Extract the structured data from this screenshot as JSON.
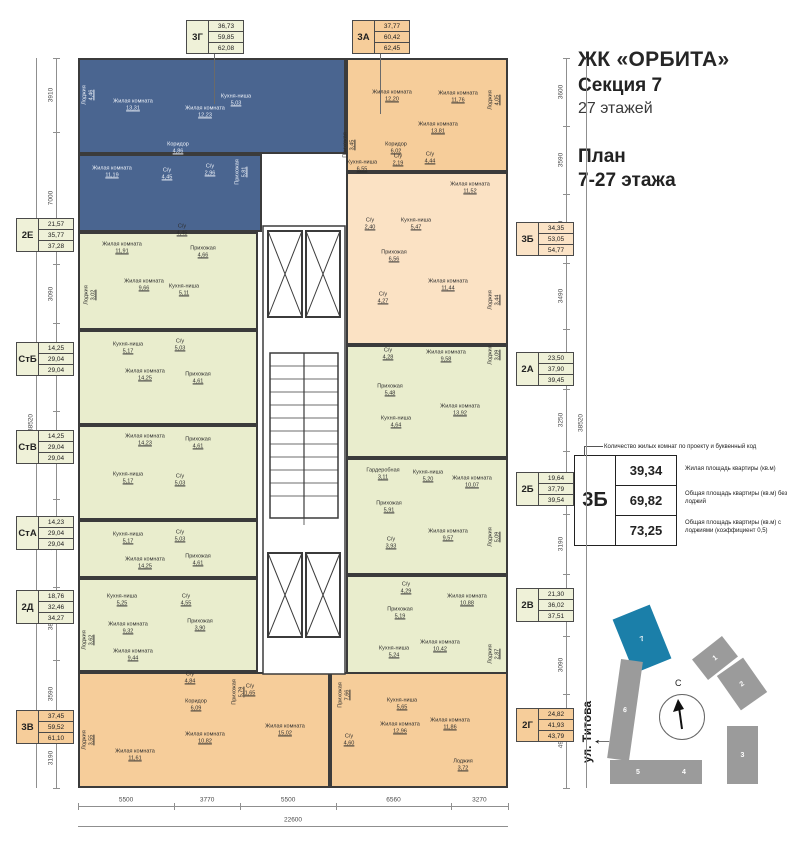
{
  "header": {
    "title": "ЖК «ОРБИТА»",
    "section": "Секция 7",
    "floors": "27 этажей",
    "plan_label": "План",
    "plan_floors": "7-27 этажа"
  },
  "legend": {
    "note": "Количество жилых комнат по проекту и буквенный код",
    "code": "3Б",
    "rows": [
      {
        "value": "39,34",
        "desc": "Жилая площадь квартиры (кв.м)"
      },
      {
        "value": "69,82",
        "desc": "Общая площадь квартиры (кв.м) без лоджий"
      },
      {
        "value": "73,25",
        "desc": "Общая площадь квартиры (кв.м) с лоджиями (коэффициент 0,5)"
      }
    ]
  },
  "site_plan": {
    "street": "ул. Титова",
    "north": "С",
    "street_arrow": "←",
    "highlighted": "7",
    "buildings": [
      "1",
      "2",
      "3",
      "4",
      "5",
      "6",
      "7"
    ]
  },
  "dimensions": {
    "left": [
      "3910",
      "7000",
      "3090",
      "4650",
      "4650",
      "4650",
      "3850",
      "3590",
      "3190"
    ],
    "right": [
      "3600",
      "3590",
      "3650",
      "3490",
      "3190",
      "3250",
      "3350",
      "3190",
      "3250",
      "3090",
      "4970"
    ],
    "bottom": [
      "5500",
      "3770",
      "5500",
      "6560",
      "3270"
    ],
    "total_width": "22600",
    "total_height": "38520"
  },
  "apartments": [
    {
      "code": "3Г",
      "area_living": "36,73",
      "area_total": "59,85",
      "area_total_loggia": "62,08",
      "rooms": [
        {
          "name": "Лоджия",
          "area": "4,46"
        },
        {
          "name": "Жилая комната",
          "area": "13,31"
        },
        {
          "name": "Жилая комната",
          "area": "12,23"
        },
        {
          "name": "Кухня-ниша",
          "area": "5,03"
        },
        {
          "name": "Жилая комната",
          "area": "11,19"
        },
        {
          "name": "Коридор",
          "area": "4,86"
        },
        {
          "name": "С/у",
          "area": "4,45"
        },
        {
          "name": "С/у",
          "area": "2,96"
        },
        {
          "name": "Прихожая",
          "area": "5,81"
        }
      ]
    },
    {
      "code": "3А",
      "area_living": "37,77",
      "area_total": "60,42",
      "area_total_loggia": "62,45",
      "rooms": [
        {
          "name": "Жилая комната",
          "area": "12,20"
        },
        {
          "name": "Жилая комната",
          "area": "11,76"
        },
        {
          "name": "Жилая комната",
          "area": "13,81"
        },
        {
          "name": "Кухня-ниша",
          "area": "6,55"
        },
        {
          "name": "Коридор",
          "area": "6,02"
        },
        {
          "name": "С/у",
          "area": "2,19"
        },
        {
          "name": "С/у",
          "area": "4,44"
        },
        {
          "name": "Прихожая",
          "area": "3,45"
        },
        {
          "name": "Лоджия",
          "area": "4,05"
        }
      ]
    },
    {
      "code": "3Б",
      "area_living": "34,35",
      "area_total": "53,05",
      "area_total_loggia": "54,77",
      "rooms": [
        {
          "name": "Жилая комната",
          "area": "11,52"
        },
        {
          "name": "С/у",
          "area": "2,40"
        },
        {
          "name": "Кухня-ниша",
          "area": "5,47"
        },
        {
          "name": "Прихожая",
          "area": "6,56"
        },
        {
          "name": "Жилая комната",
          "area": "11,44"
        },
        {
          "name": "С/у",
          "area": "4,27"
        },
        {
          "name": "Лоджия",
          "area": "3,44"
        }
      ]
    },
    {
      "code": "2Е",
      "area_living": "21,57",
      "area_total": "35,77",
      "area_total_loggia": "37,28",
      "rooms": [
        {
          "name": "Жилая комната",
          "area": "11,91"
        },
        {
          "name": "С/у",
          "area": "4,45"
        },
        {
          "name": "Прихожая",
          "area": "4,66"
        },
        {
          "name": "Жилая комната",
          "area": "9,66"
        },
        {
          "name": "Кухня-ниша",
          "area": "5,11"
        },
        {
          "name": "Лоджия",
          "area": "3,02"
        }
      ]
    },
    {
      "code": "СтБ",
      "area_living": "14,25",
      "area_total": "29,04",
      "area_total_loggia": "29,04",
      "rooms": [
        {
          "name": "Кухня-ниша",
          "area": "5,17"
        },
        {
          "name": "С/у",
          "area": "5,03"
        },
        {
          "name": "Жилая комната",
          "area": "14,25"
        },
        {
          "name": "Прихожая",
          "area": "4,61"
        }
      ]
    },
    {
      "code": "СтВ",
      "area_living": "14,25",
      "area_total": "29,04",
      "area_total_loggia": "29,04",
      "rooms": [
        {
          "name": "Жилая комната",
          "area": "14,23"
        },
        {
          "name": "Прихожая",
          "area": "4,61"
        },
        {
          "name": "Кухня-ниша",
          "area": "5,17"
        },
        {
          "name": "С/у",
          "area": "5,03"
        }
      ]
    },
    {
      "code": "СтА",
      "area_living": "14,23",
      "area_total": "29,04",
      "area_total_loggia": "29,04",
      "rooms": [
        {
          "name": "Кухня-ниша",
          "area": "5,17"
        },
        {
          "name": "С/у",
          "area": "5,03"
        },
        {
          "name": "Жилая комната",
          "area": "14,25"
        },
        {
          "name": "Прихожая",
          "area": "4,61"
        }
      ]
    },
    {
      "code": "2Д",
      "area_living": "18,76",
      "area_total": "32,46",
      "area_total_loggia": "34,27",
      "rooms": [
        {
          "name": "Кухня-ниша",
          "area": "5,25"
        },
        {
          "name": "С/у",
          "area": "4,55"
        },
        {
          "name": "Жилая комната",
          "area": "9,32"
        },
        {
          "name": "Прихожая",
          "area": "3,90"
        },
        {
          "name": "Жилая комната",
          "area": "9,44"
        },
        {
          "name": "Лоджия",
          "area": "3,62"
        }
      ]
    },
    {
      "code": "3В",
      "area_living": "37,45",
      "area_total": "59,52",
      "area_total_loggia": "61,10",
      "rooms": [
        {
          "name": "Прихожая",
          "area": "5,79"
        },
        {
          "name": "С/у",
          "area": "4,84"
        },
        {
          "name": "С/у",
          "area": "1,65"
        },
        {
          "name": "Коридор",
          "area": "6,09"
        },
        {
          "name": "Жилая комната",
          "area": "11,61"
        },
        {
          "name": "Жилая комната",
          "area": "10,82"
        },
        {
          "name": "Жилая комната",
          "area": "15,02"
        },
        {
          "name": "Лоджия",
          "area": "3,55"
        }
      ]
    },
    {
      "code": "2А",
      "area_living": "23,50",
      "area_total": "37,90",
      "area_total_loggia": "39,45",
      "rooms": [
        {
          "name": "С/у",
          "area": "4,28"
        },
        {
          "name": "Жилая комната",
          "area": "9,58"
        },
        {
          "name": "Прихожая",
          "area": "5,48"
        },
        {
          "name": "Жилая комната",
          "area": "13,92"
        },
        {
          "name": "Кухня-ниша",
          "area": "4,64"
        },
        {
          "name": "Лоджия",
          "area": "3,09"
        }
      ]
    },
    {
      "code": "2Б",
      "area_living": "19,64",
      "area_total": "37,79",
      "area_total_loggia": "39,54",
      "rooms": [
        {
          "name": "Гардеробная",
          "area": "3,11"
        },
        {
          "name": "Кухня-ниша",
          "area": "5,20"
        },
        {
          "name": "Жилая комната",
          "area": "10,07"
        },
        {
          "name": "Прихожая",
          "area": "5,91"
        },
        {
          "name": "С/у",
          "area": "3,93"
        },
        {
          "name": "Жилая комната",
          "area": "9,57"
        },
        {
          "name": "Лоджия",
          "area": "5,09"
        }
      ]
    },
    {
      "code": "2В",
      "area_living": "21,30",
      "area_total": "36,02",
      "area_total_loggia": "37,51",
      "rooms": [
        {
          "name": "С/у",
          "area": "4,29"
        },
        {
          "name": "Прихожая",
          "area": "5,19"
        },
        {
          "name": "Жилая комната",
          "area": "10,88"
        },
        {
          "name": "Жилая комната",
          "area": "10,42"
        },
        {
          "name": "Кухня-ниша",
          "area": "5,24"
        },
        {
          "name": "Лоджия",
          "area": "2,87"
        }
      ]
    },
    {
      "code": "2Г",
      "area_living": "24,82",
      "area_total": "41,93",
      "area_total_loggia": "43,79",
      "rooms": [
        {
          "name": "Прихожая",
          "area": "7,66"
        },
        {
          "name": "Кухня-ниша",
          "area": "5,65"
        },
        {
          "name": "Жилая комната",
          "area": "12,96"
        },
        {
          "name": "Жилая комната",
          "area": "11,86"
        },
        {
          "name": "С/у",
          "area": "4,60"
        },
        {
          "name": "Лоджия",
          "area": "3,72"
        }
      ]
    }
  ]
}
